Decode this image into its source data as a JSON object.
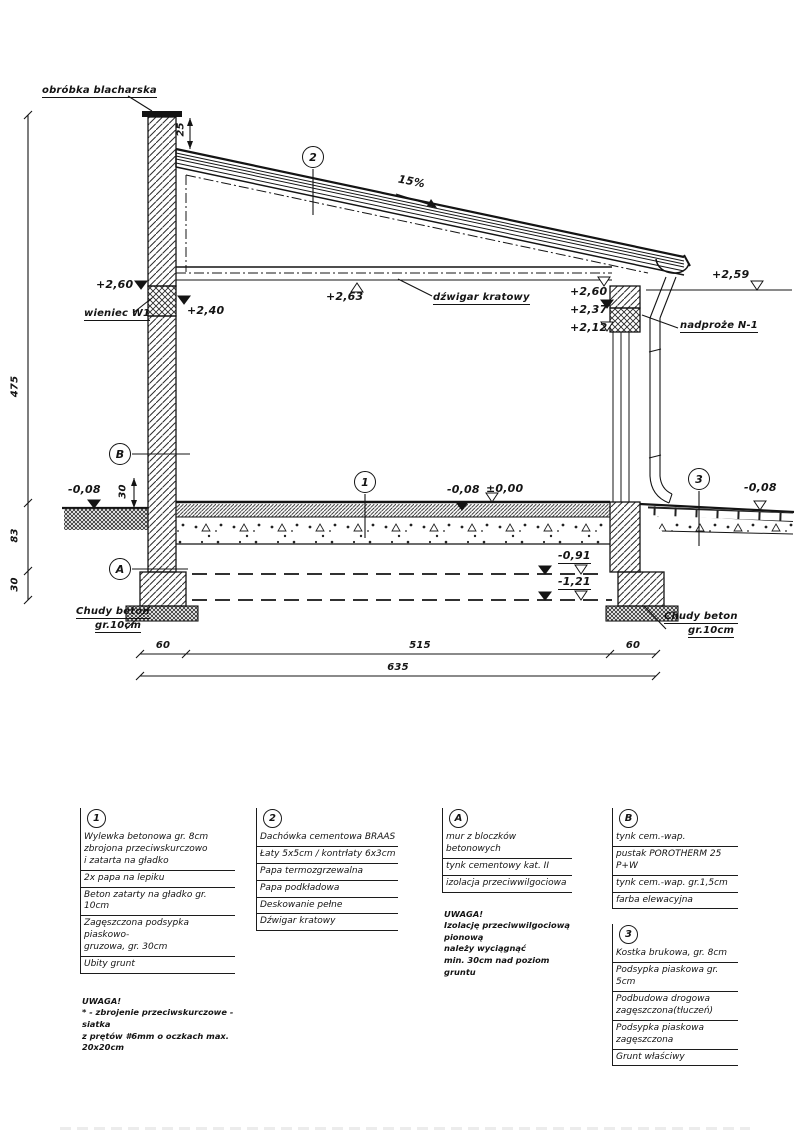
{
  "drawing": {
    "callouts": {
      "one": "1",
      "two": "2",
      "three": "3",
      "a": "A",
      "b": "B"
    },
    "labels": {
      "flashing": "obróbka blacharska",
      "slope": "15%",
      "ring_beam": "wieniec W1",
      "truss": "dźwigar kratowy",
      "lintel": "nadproże N-1",
      "lean_concrete": "Chudy beton",
      "lean_concrete_thickness": "gr.10cm"
    },
    "elevations": {
      "e260l": "+2,60",
      "e240": "+2,40",
      "e263": "+2,63",
      "e260r": "+2,60",
      "e237": "+2,37",
      "e212": "+2,12",
      "e259": "+2,59",
      "m008l": "-0,08",
      "m008m": "-0,08",
      "zero": "±0,00",
      "m091": "-0,91",
      "m121": "-1,21",
      "m008r": "-0,08"
    },
    "dims": {
      "d25": "25",
      "d475": "475",
      "d83": "83",
      "d30": "30",
      "d30g": "30",
      "d60l": "60",
      "d515": "515",
      "d60r": "60",
      "d635": "635"
    }
  },
  "legend": {
    "col1": {
      "badge": "1",
      "items": [
        "Wylewka betonowa gr. 8cm\nzbrojona przeciwskurczowo\ni zatarta na gładko",
        "2x papa na lepiku",
        "Beton zatarty na gładko gr. 10cm",
        "Zagęszczona podsypka piaskowo-\ngruzowa, gr. 30cm",
        "Ubity grunt"
      ],
      "note": "UWAGA!\n* - zbrojenie przeciwskurczowe - siatka\nz prętów #6mm o oczkach max. 20x20cm"
    },
    "col2": {
      "badge": "2",
      "items": [
        "Dachówka cementowa BRAAS",
        "Łaty 5x5cm / kontrłaty 6x3cm",
        "Papa termozgrzewalna",
        "Papa podkładowa",
        "Deskowanie pełne",
        "Dźwigar kratowy"
      ]
    },
    "colA": {
      "badge": "A",
      "items": [
        "mur z bloczków betonowych",
        "tynk cementowy kat. II",
        "izolacja przeciwwilgociowa"
      ],
      "note": "UWAGA!\nIzolację przeciwwilgociową pionową\nnależy wyciągnąć\nmin. 30cm nad poziom gruntu"
    },
    "colB": {
      "badge": "B",
      "items": [
        "tynk cem.-wap.",
        "pustak POROTHERM 25 P+W",
        "tynk cem.-wap. gr.1,5cm",
        "farba elewacyjna"
      ]
    },
    "col3": {
      "badge": "3",
      "items": [
        "Kostka brukowa, gr. 8cm",
        "Podsypka piaskowa gr. 5cm",
        "Podbudowa drogowa\nzagęszczona(tłuczeń)",
        "Podsypka piaskowa zagęszczona",
        "Grunt właściwy"
      ]
    }
  }
}
